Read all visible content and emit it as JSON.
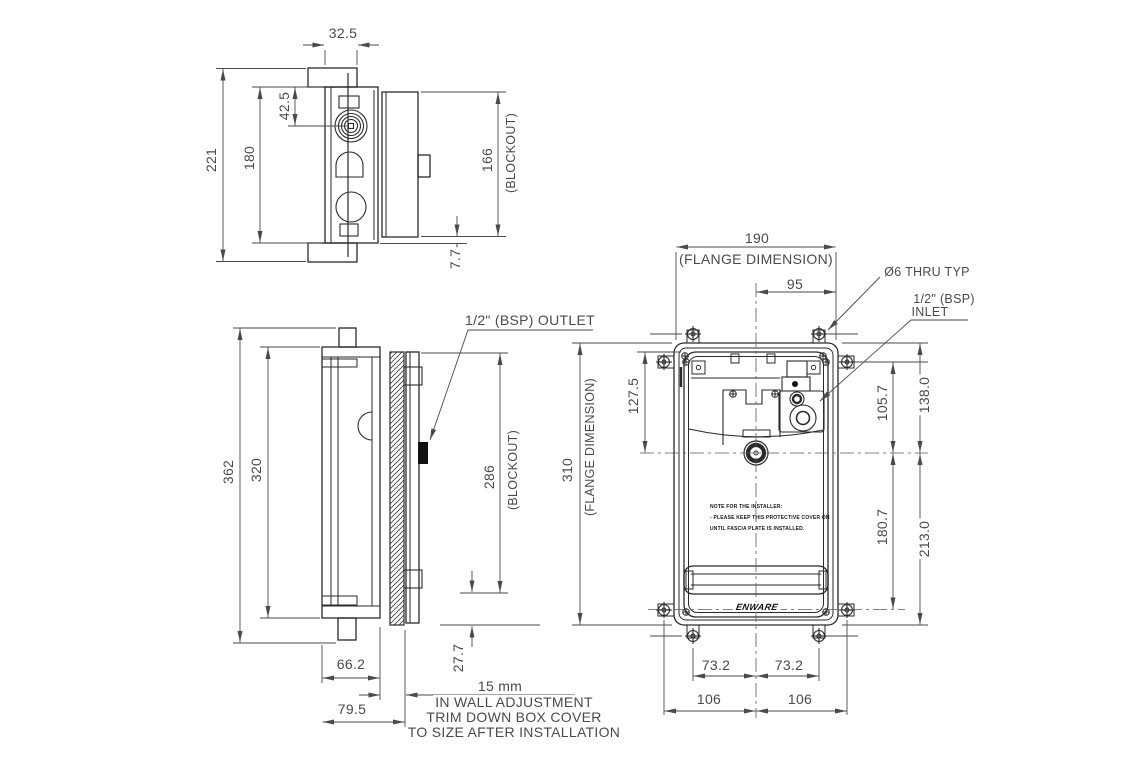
{
  "drawing": {
    "top_view": {
      "dim_flange_thickness": "32.5",
      "dim_overall_height": "221",
      "dim_body_height": "180",
      "dim_knob_offset": "42.5",
      "dim_blockout": "166",
      "blockout_label": "(BLOCKOUT)",
      "dim_cover_lip": "7.7"
    },
    "side_view": {
      "dim_overall_height": "362",
      "dim_body_height": "320",
      "outlet_label": "1/2\" (BSP) OUTLET",
      "dim_blockout": "286",
      "blockout_label": "(BLOCKOUT)",
      "dim_cover_lip": "27.7",
      "dim_body_depth": "66.2",
      "dim_overall_depth": "79.5",
      "dim_adjustment": "15 mm",
      "adjustment_note": [
        "IN WALL ADJUSTMENT",
        "TRIM DOWN BOX COVER",
        "TO SIZE AFTER INSTALLATION"
      ]
    },
    "front_view": {
      "dim_flange_width": "190",
      "flange_width_label": "(FLANGE DIMENSION)",
      "dim_half_width": "95",
      "thru_hole_label": "Ø6 THRU TYP",
      "inlet_label_line1": "1/2\" (BSP)",
      "inlet_label_line2": "INLET",
      "dim_flange_height": "310",
      "flange_height_label": "(FLANGE DIMENSION)",
      "dim_top_to_centre": "127.5",
      "dim_inlet_to_centre": "105.7",
      "dim_flange_top_to_centre": "138.0",
      "dim_centre_to_screw": "180.7",
      "dim_centre_to_flange_bottom": "213.0",
      "dim_screw_left": "73.2",
      "dim_screw_right": "73.2",
      "dim_hole_left": "106",
      "dim_hole_right": "106",
      "installer_note": [
        "NOTE FOR THE INSTALLER:",
        "- PLEASE KEEP THIS PROTECTIVE COVER ON",
        "UNTIL FASCIA PLATE IS INSTALLED."
      ],
      "brand": "ENWARE"
    }
  }
}
